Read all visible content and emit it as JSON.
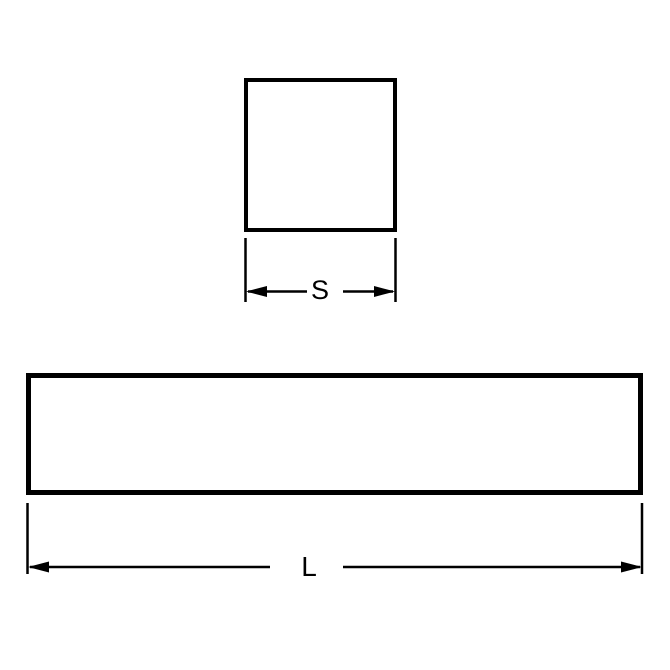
{
  "diagram": {
    "background_color": "#ffffff",
    "line_color": "#000000",
    "square_view": {
      "description": "square cross-section",
      "dimension_label": "S"
    },
    "bar_view": {
      "description": "bar side view length",
      "dimension_label": "L"
    }
  }
}
